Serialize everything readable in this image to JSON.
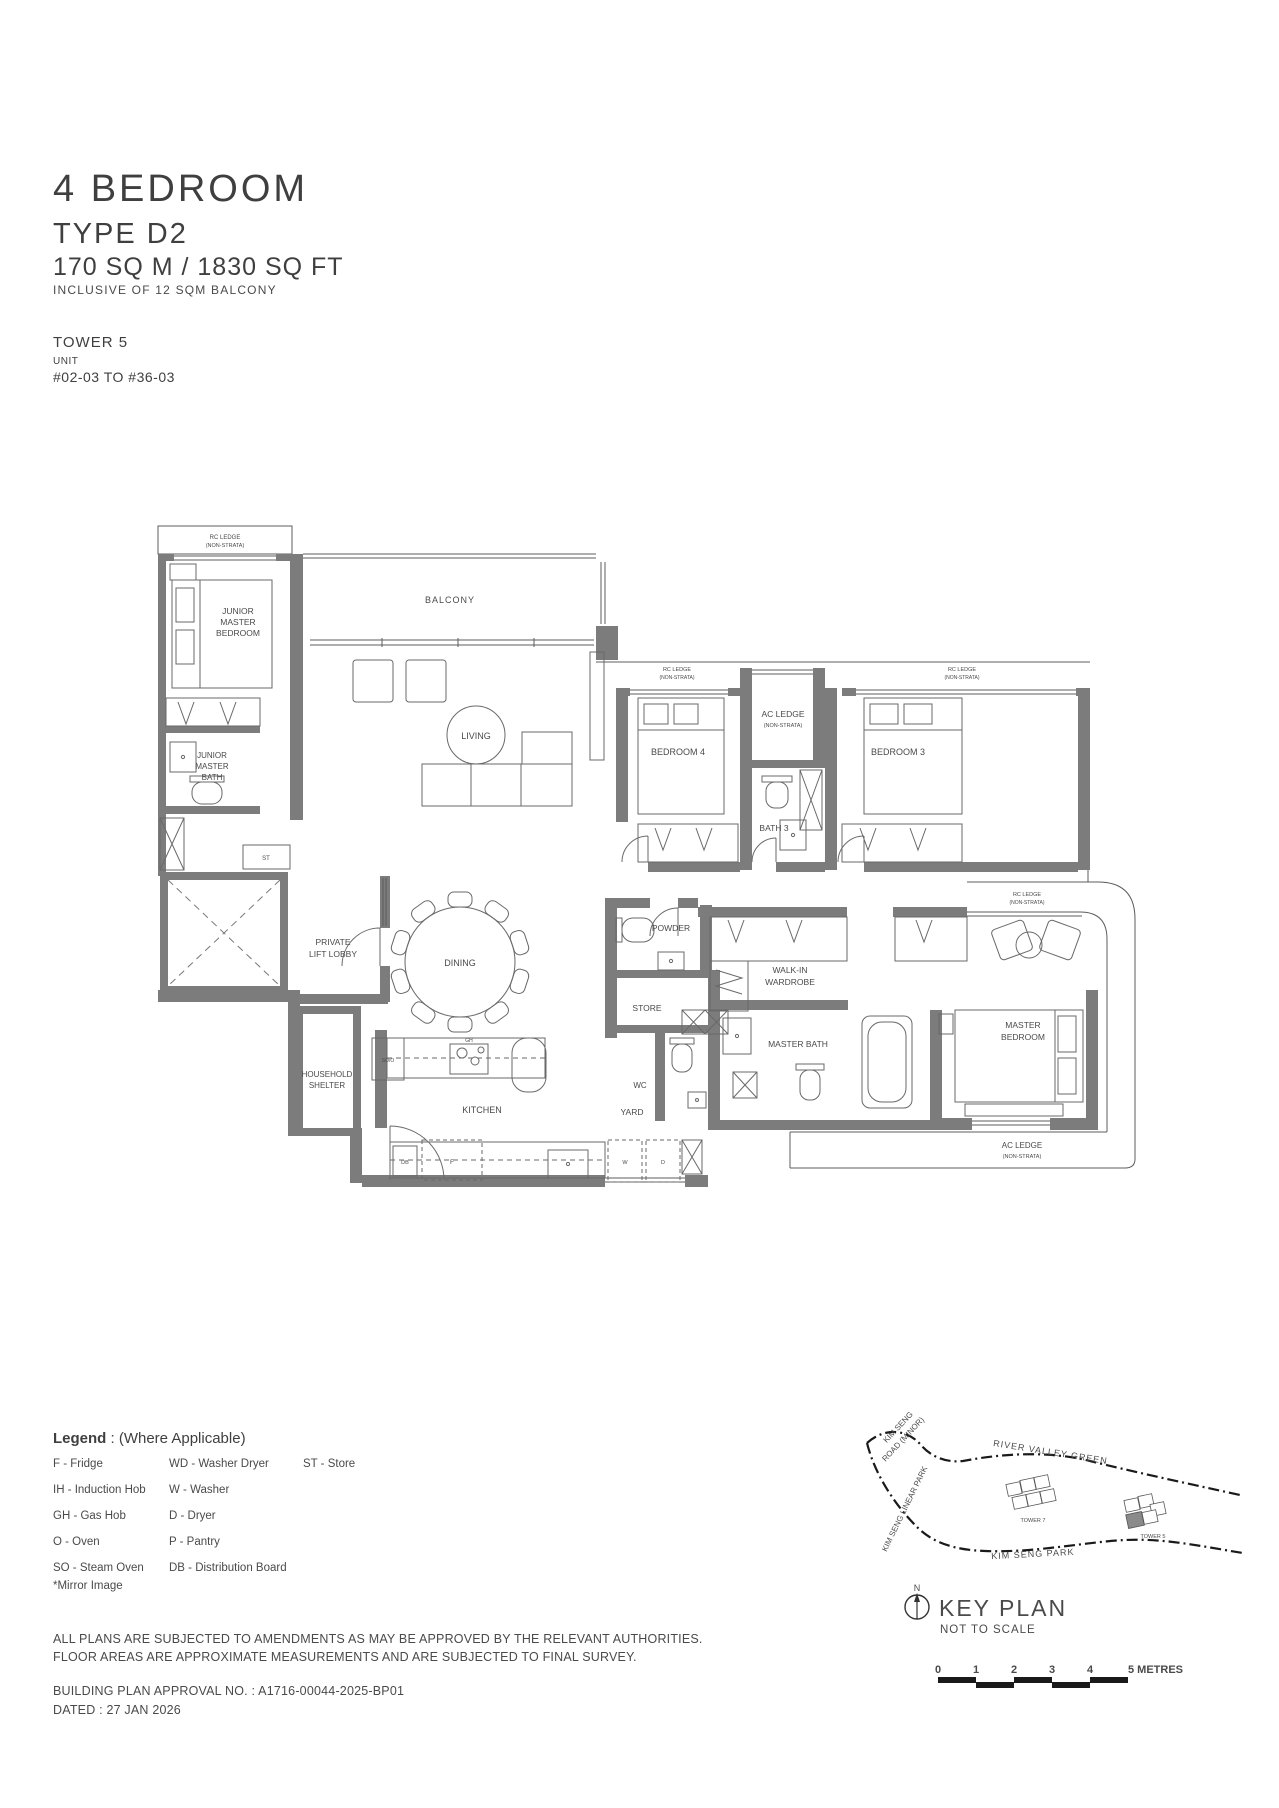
{
  "header": {
    "title": "4 BEDROOM",
    "type": "TYPE D2",
    "area": "170 SQ M / 1830 SQ FT",
    "note": "INCLUSIVE OF 12 SQM BALCONY",
    "tower": "TOWER 5",
    "unit_label": "UNIT",
    "unit_range": "#02-03 TO #36-03"
  },
  "plan": {
    "labels": {
      "rc_ledge": "RC LEDGE",
      "non_strata": "(NON-STRATA)",
      "ac_ledge": "AC LEDGE",
      "junior": "JUNIOR",
      "master": "MASTER",
      "bedroom": "BEDROOM",
      "bath": "BATH",
      "balcony": "BALCONY",
      "living": "LIVING",
      "bedroom_4": "BEDROOM 4",
      "bedroom_3": "BEDROOM 3",
      "bath_3": "BATH 3",
      "private": "PRIVATE",
      "lift_lobby": "LIFT LOBBY",
      "dining": "DINING",
      "powder": "POWDER",
      "walk_in": "WALK-IN",
      "wardrobe": "WARDROBE",
      "store": "STORE",
      "master_bath": "MASTER BATH",
      "wc": "WC",
      "yard": "YARD",
      "household": "HOUSEHOLD",
      "shelter": "SHELTER",
      "kitchen": "KITCHEN",
      "st": "ST",
      "so_o": "SO/O",
      "gh": "GH",
      "db": "DB",
      "f": "F",
      "w": "W",
      "d": "D"
    }
  },
  "legend": {
    "title": "Legend",
    "title_suffix": " : (Where Applicable)",
    "col1": [
      "F - Fridge",
      "IH - Induction Hob",
      "GH - Gas Hob",
      "O - Oven",
      "SO - Steam Oven"
    ],
    "col2": [
      "WD - Washer Dryer",
      "W - Washer",
      "D - Dryer",
      "P - Pantry",
      "DB - Distribution Board"
    ],
    "col3": [
      "ST - Store"
    ],
    "mirror": "*Mirror Image"
  },
  "key_plan": {
    "road1a": "KIM SENG",
    "road1b": "ROAD (MINOR)",
    "river_valley": "RIVER VALLEY GREEN",
    "linear_park": "KIM SENG LINEAR PARK",
    "kim_seng_park": "KIM SENG PARK",
    "tower7": "TOWER 7",
    "tower5": "TOWER 5",
    "north": "N",
    "title": "KEY PLAN",
    "subtitle": "NOT TO SCALE"
  },
  "scale_bar": {
    "m0": "0",
    "m1": "1",
    "m2": "2",
    "m3": "3",
    "m4": "4",
    "m5": "5 METRES"
  },
  "footer": {
    "line1": "ALL PLANS ARE SUBJECTED TO AMENDMENTS AS MAY BE APPROVED BY THE RELEVANT AUTHORITIES.",
    "line2": "FLOOR AREAS ARE APPROXIMATE MEASUREMENTS AND ARE SUBJECTED TO FINAL SURVEY.",
    "approval": "BUILDING PLAN APPROVAL NO. : A1716-00044-2025-BP01",
    "dated": "DATED : 27 JAN 2026"
  }
}
